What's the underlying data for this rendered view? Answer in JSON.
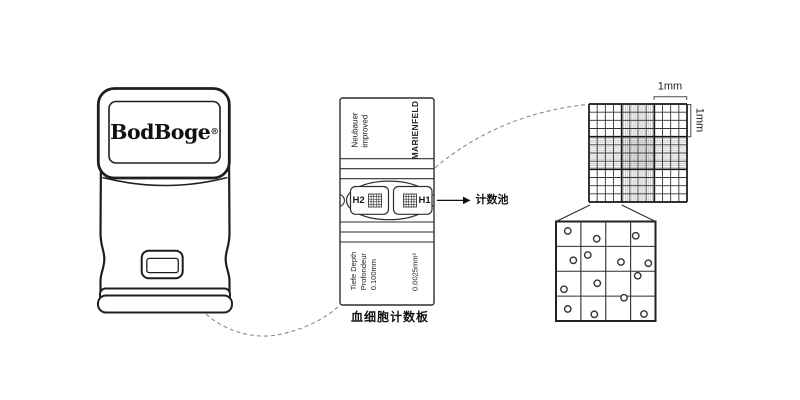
{
  "device": {
    "brand": "BodBoge",
    "reg_mark": "®"
  },
  "slide": {
    "top_left_text": "Neubauer\nimproved",
    "top_right_text": "MARIENFELD",
    "left_chamber_label": "H2",
    "right_chamber_label": "H1",
    "bottom_left_text": "Tiefe Depth\nProfondeur\n0.100mm",
    "bottom_right_text": "0.0025mm²",
    "pointer_label": "计数池",
    "caption": "血细胞计数板"
  },
  "magnifier": {
    "width_label": "1mm",
    "height_label": "1mm",
    "grid": {
      "divisions": 12,
      "major_every": 4,
      "fine_subdivisions": 4
    },
    "zoom_square": {
      "rows": 4,
      "cols": 4
    },
    "cells": [
      {
        "x": 11.8,
        "y": 9.5
      },
      {
        "x": 40.9,
        "y": 17.3
      },
      {
        "x": 80.1,
        "y": 14.3
      },
      {
        "x": 17.4,
        "y": 39.0
      },
      {
        "x": 31.9,
        "y": 33.7
      },
      {
        "x": 65.3,
        "y": 40.7
      },
      {
        "x": 92.8,
        "y": 42.0
      },
      {
        "x": 82.1,
        "y": 54.5
      },
      {
        "x": 41.5,
        "y": 62.1
      },
      {
        "x": 8.0,
        "y": 68.1
      },
      {
        "x": 68.3,
        "y": 76.6
      },
      {
        "x": 11.8,
        "y": 87.9
      },
      {
        "x": 38.5,
        "y": 93.3
      },
      {
        "x": 88.4,
        "y": 93.0
      }
    ]
  },
  "colors": {
    "ink": "#1f1f1f",
    "slide_line": "#2f2f2f",
    "fine_line": "#ababab",
    "dash": "#8a8a8a"
  }
}
